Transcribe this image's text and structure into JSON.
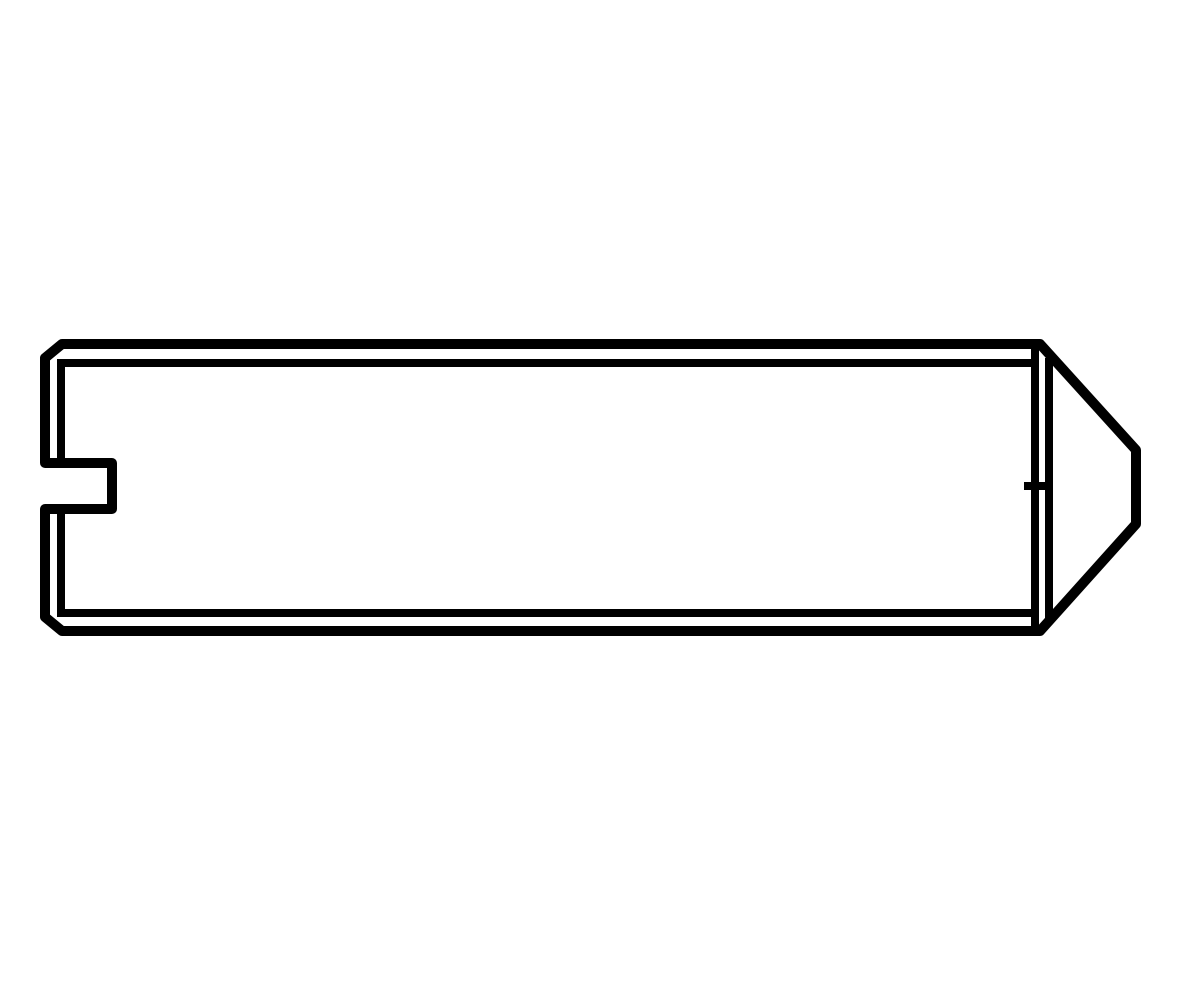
{
  "page": {
    "background_color": "#ffffff",
    "description": "Technical line drawing, side view of a slotted set screw with cone point (DIN 553 style). Black outline on white background, no text or labels."
  },
  "drawing": {
    "stroke_color": "#000000",
    "fill_color": "none",
    "outer_stroke_width": 10,
    "inner_stroke_width": 8,
    "viewbox": "0 0 1200 1000",
    "outer_profile": {
      "name": "screw-outer-profile",
      "points": "62,344 1040,344 1136,450 1136,524 1040,631 62,631 45,617 45,509 112,509 112,463 45,463 45,358"
    },
    "inner_lines": [
      {
        "name": "thread-root-line-top",
        "x1": 57,
        "y1": 363,
        "x2": 1035,
        "y2": 363
      },
      {
        "name": "thread-root-line-bottom",
        "x1": 57,
        "y1": 613,
        "x2": 1035,
        "y2": 613
      },
      {
        "name": "left-chamfer-line-upper",
        "x1": 61,
        "y1": 360,
        "x2": 61,
        "y2": 463
      },
      {
        "name": "left-chamfer-line-lower",
        "x1": 61,
        "y1": 509,
        "x2": 61,
        "y2": 616
      },
      {
        "name": "point-shoulder-line",
        "x1": 1035,
        "y1": 346,
        "x2": 1035,
        "y2": 629
      },
      {
        "name": "cone-base-line",
        "x1": 1049,
        "y1": 358,
        "x2": 1049,
        "y2": 620
      },
      {
        "name": "center-axis-tick",
        "x1": 1024,
        "y1": 486,
        "x2": 1053,
        "y2": 486
      }
    ]
  }
}
